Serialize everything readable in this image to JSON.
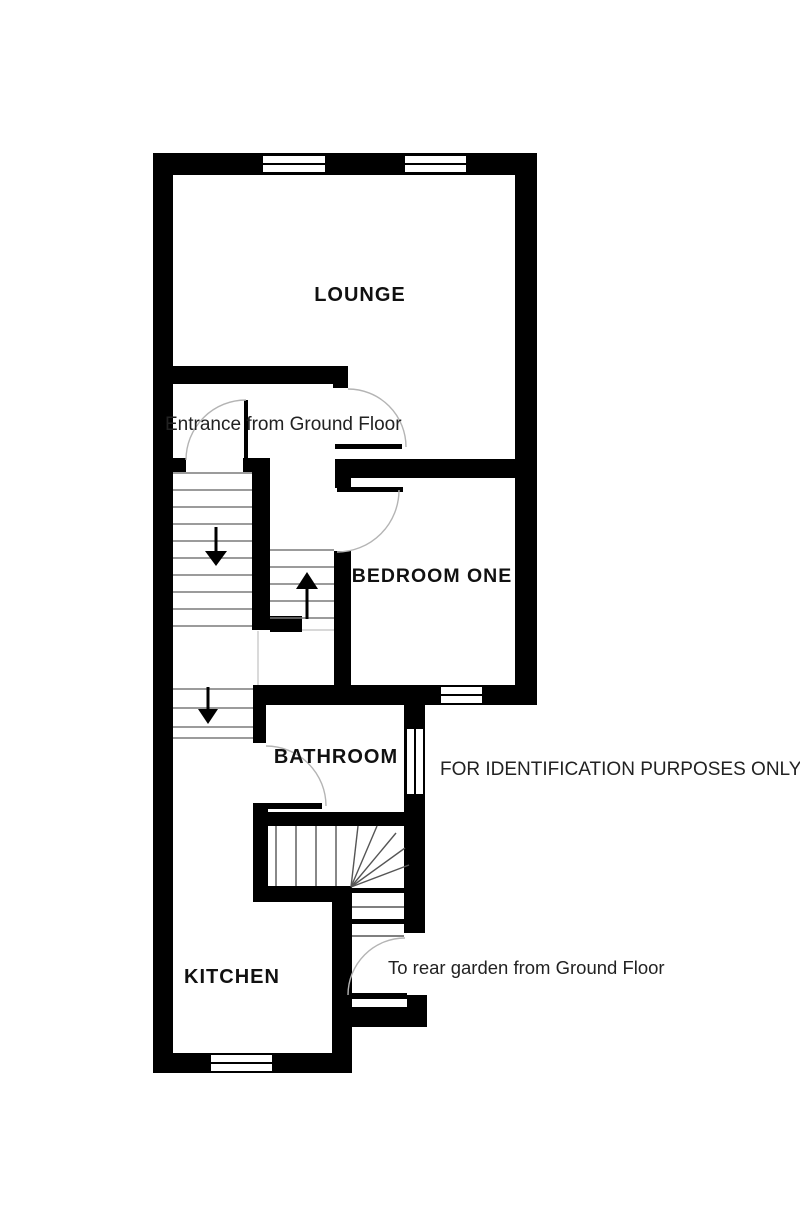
{
  "floorplan": {
    "rooms": [
      {
        "id": "lounge",
        "label": "LOUNGE"
      },
      {
        "id": "bedroom-one",
        "label": "BEDROOM ONE"
      },
      {
        "id": "bathroom",
        "label": "BATHROOM"
      },
      {
        "id": "kitchen",
        "label": "KITCHEN"
      }
    ],
    "annotations": [
      {
        "id": "entrance",
        "label": "Entrance from Ground Floor"
      },
      {
        "id": "identification",
        "label": "FOR IDENTIFICATION PURPOSES ONLY"
      },
      {
        "id": "rear-garden",
        "label": "To rear garden from Ground Floor"
      }
    ],
    "colors": {
      "wall": "#000000",
      "background": "#ffffff",
      "door_arc": "#b4b4b4",
      "stair_tread": "#7a7a7a"
    }
  }
}
